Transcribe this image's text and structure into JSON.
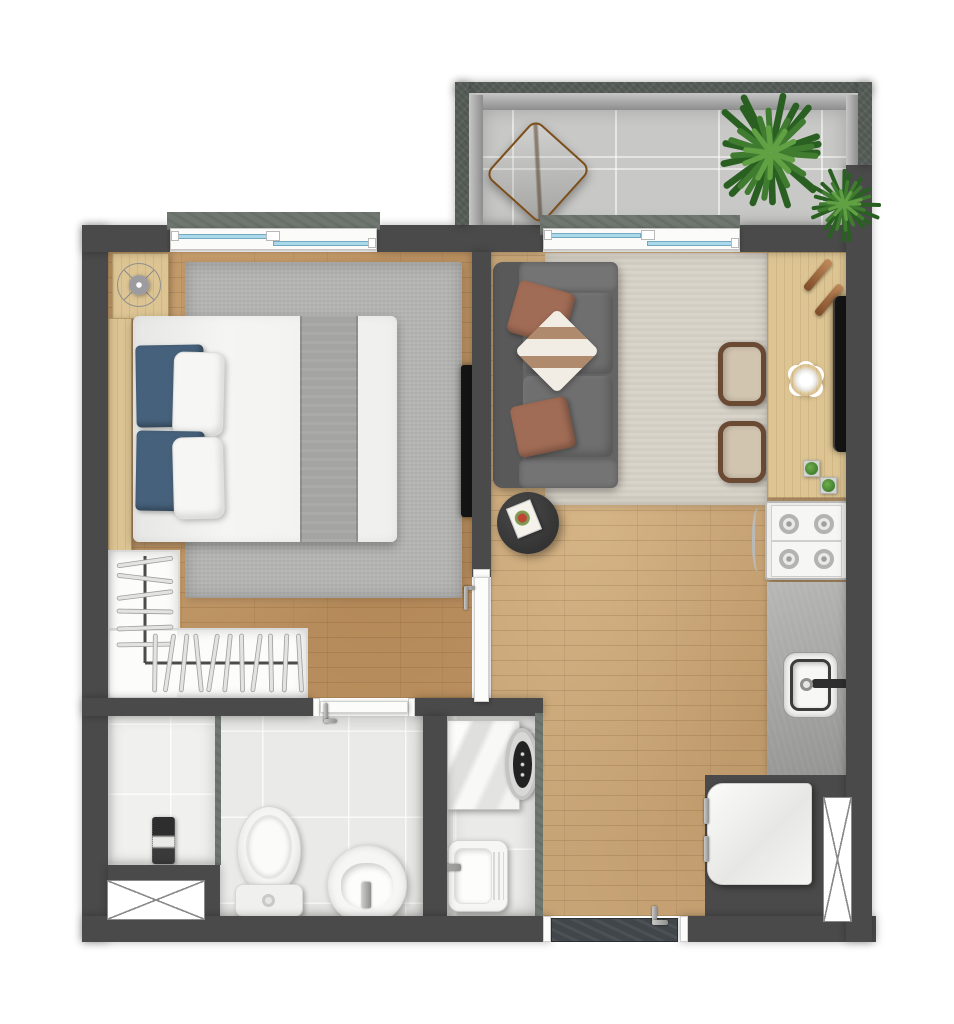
{
  "plan": {
    "type": "apartment-floor-plan",
    "view": "top-down",
    "rooms": [
      {
        "name": "balcony",
        "items": [
          "lounge-chair",
          "potted-plant-large",
          "potted-plant-small",
          "sliding-glass-door"
        ]
      },
      {
        "name": "bedroom",
        "items": [
          "sliding-window",
          "nightstand",
          "table-lamp",
          "double-bed",
          "headboard",
          "blue-pillows",
          "white-pillows",
          "gray-runner-blanket",
          "area-rug",
          "wall-tv",
          "wardrobe-closet",
          "door"
        ]
      },
      {
        "name": "living-dining",
        "items": [
          "sofa",
          "terracotta-pillows",
          "chevron-pillow",
          "coffee-table",
          "magazine",
          "area-rug",
          "dining-chair-1",
          "dining-chair-2",
          "counter-table",
          "tv",
          "flower-vase",
          "decor-bottles",
          "mini-potted-plants",
          "entry-door"
        ]
      },
      {
        "name": "kitchen",
        "items": [
          "cooktop-4-burner",
          "oven-handle",
          "concrete-countertop",
          "inset-sink",
          "faucet",
          "refrigerator",
          "service-shaft"
        ]
      },
      {
        "name": "bathroom",
        "items": [
          "shower-area",
          "glass-divider",
          "drain-column",
          "toilet",
          "round-washbasin",
          "door",
          "service-shaft"
        ]
      },
      {
        "name": "laundry",
        "items": [
          "washing-machine",
          "laundry-tub",
          "faucet"
        ]
      }
    ],
    "palette": {
      "wall": "#4a4a4a",
      "parapet_textured": "#575d59",
      "parapet_coping": "#c6c6c6",
      "slate_sill": "#707771",
      "wood_bedroom": "#bb9161",
      "wood_living": "#c7a476",
      "balcony_tile": "#c8c8c6",
      "bath_tile": "#eaeae8",
      "rug_bedroom": "#b4b4b2",
      "rug_living": "#d9d4c9",
      "sofa_gray": "#646464",
      "pillow_terracotta": "#a16c56",
      "pillow_blue": "#46617b",
      "bed_linen": "#f1f1f0",
      "blanket_gray": "#a4a4a2",
      "counter_wood": "#dcc493",
      "kitchen_concrete": "#a5a5a3",
      "chair_frame": "#6b4a33",
      "chair_cushion": "#d2c5b0",
      "lounge_chair": "#b3722e",
      "plant_green": "#3f7c2f",
      "tv_black": "#141414",
      "fixture_white": "#f4f4f3",
      "entry_door_slate": "#40464a",
      "window_glass": "#a9d9ea"
    }
  }
}
